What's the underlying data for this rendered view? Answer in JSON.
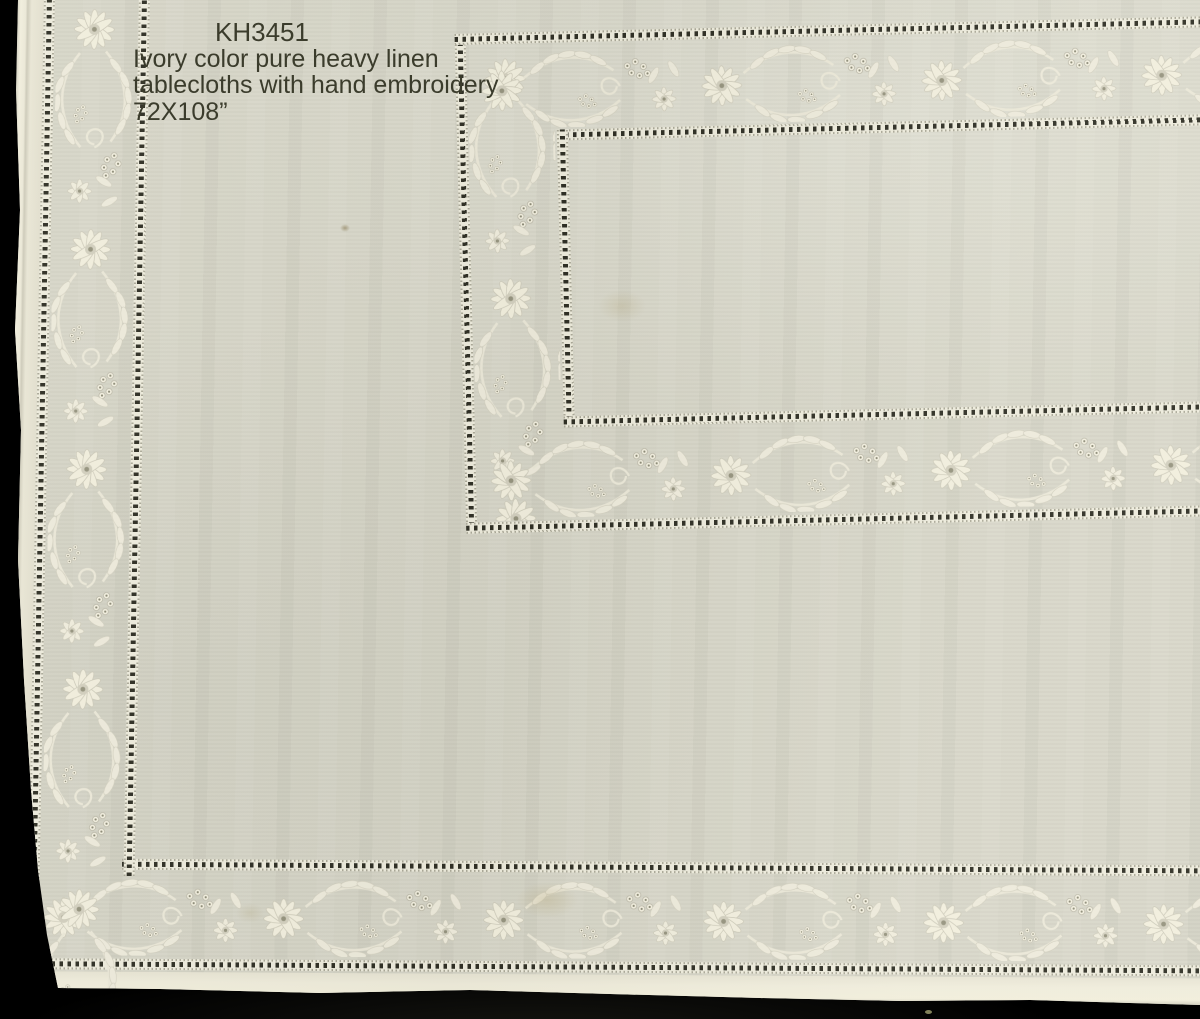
{
  "caption": {
    "product_code": "KH3451",
    "line1": "Ivory color pure heavy linen",
    "line2": "tablecloths with hand embroidery",
    "line3": "72X108”"
  },
  "photo": {
    "description": "Corner view of an ivory heavy linen tablecloth with hand-embroidered floral borders and hemstitch drawn-thread lines, photographed on a black background",
    "colors": {
      "background": "#020202",
      "fabric": "#d7d6c8",
      "hem_edge": "#f0eddc",
      "hemstitch_openwork": "#edebdc",
      "hemstitch_dot": "#20201 6",
      "embroidery": "#f1eede",
      "embroidery_shadow": "#cbc8b7",
      "caption_text": "#3b3c2c"
    }
  }
}
